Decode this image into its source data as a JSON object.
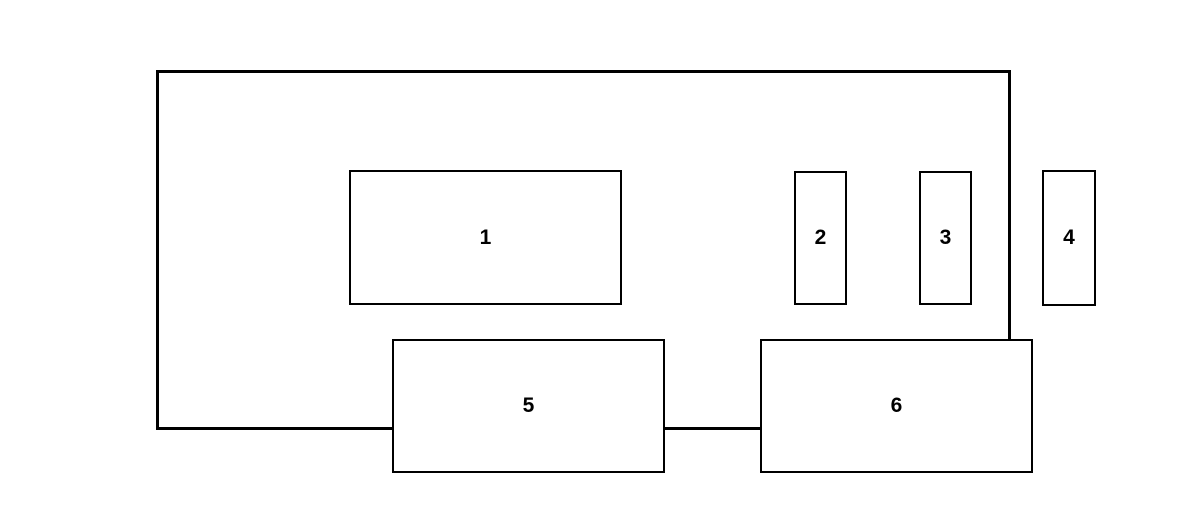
{
  "diagram": {
    "background_color": "#ffffff",
    "line_color": "#000000",
    "boxes": [
      {
        "label": "1"
      },
      {
        "label": "2"
      },
      {
        "label": "3"
      },
      {
        "label": "4"
      },
      {
        "label": "5"
      },
      {
        "label": "6"
      }
    ]
  }
}
